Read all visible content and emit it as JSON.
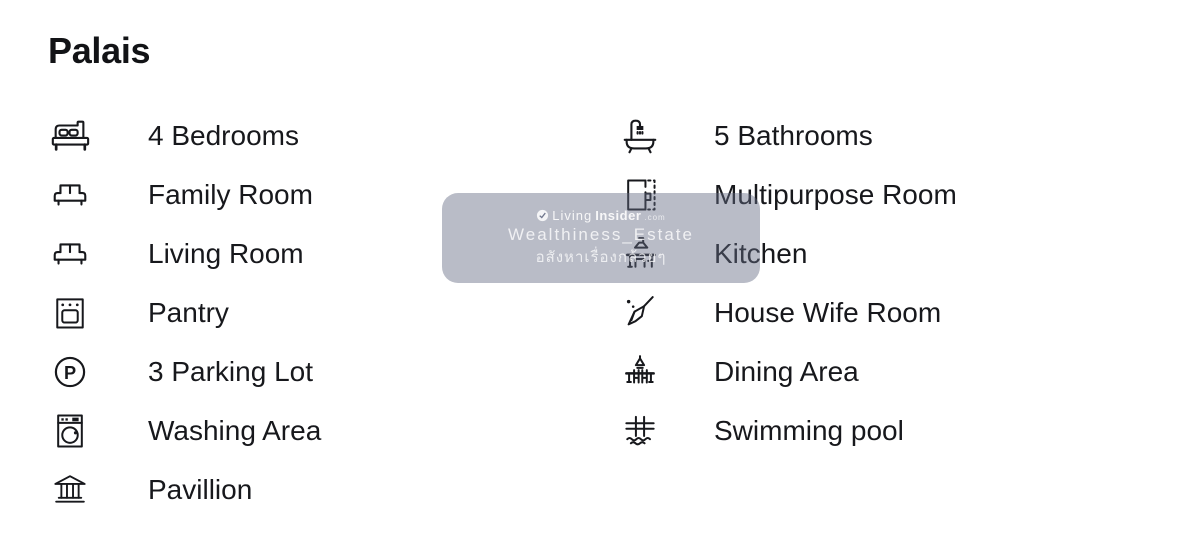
{
  "page": {
    "title": "Palais"
  },
  "colors": {
    "text": "#17181C",
    "watermark_overlay": "#636A82",
    "watermark_text": "#FFFFFF"
  },
  "features": {
    "left": [
      {
        "icon": "bed-icon",
        "label": "4 Bedrooms"
      },
      {
        "icon": "sofa-icon",
        "label": "Family Room"
      },
      {
        "icon": "sofa-icon",
        "label": "Living Room"
      },
      {
        "icon": "oven-icon",
        "label": "Pantry"
      },
      {
        "icon": "parking-icon",
        "label": "3 Parking Lot"
      },
      {
        "icon": "washing-machine-icon",
        "label": "Washing Area"
      },
      {
        "icon": "pavilion-icon",
        "label": "Pavillion"
      }
    ],
    "right": [
      {
        "icon": "bathtub-icon",
        "label": "5 Bathrooms"
      },
      {
        "icon": "floor-plan-icon",
        "label": "Multipurpose Room"
      },
      {
        "icon": "kitchen-icon",
        "label": "Kitchen"
      },
      {
        "icon": "broom-icon",
        "label": "House Wife Room"
      },
      {
        "icon": "dining-icon",
        "label": "Dining Area"
      },
      {
        "icon": "pool-ladder-icon",
        "label": "Swimming pool"
      }
    ]
  },
  "watermark": {
    "brand_prefix": "Living",
    "brand_suffix": "Insider",
    "brand_tld": ".com",
    "line2": "Wealthiness_Estate",
    "line3": "อสังหาเรื่องกล้วยๆ"
  }
}
